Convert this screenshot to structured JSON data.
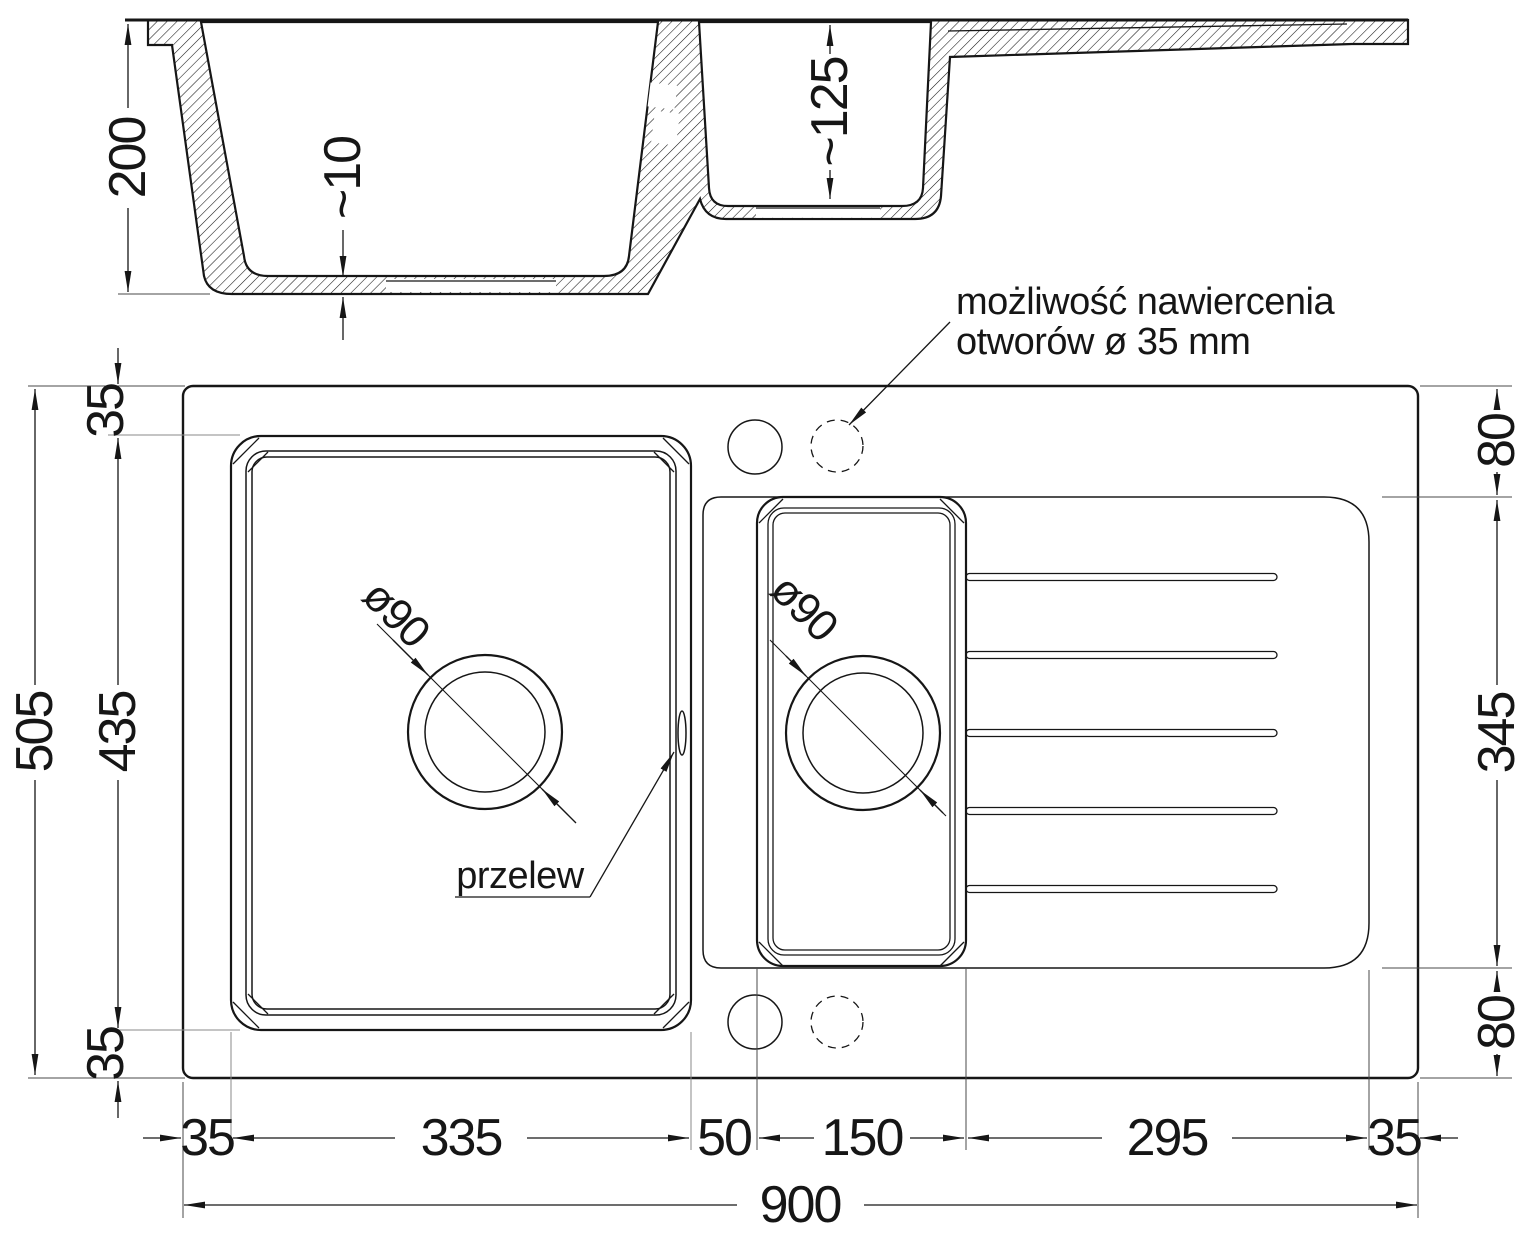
{
  "drawing": {
    "colors": {
      "line": "#161616",
      "background": "#ffffff"
    },
    "section_view": {
      "depth_main": "200",
      "floor_thickness": "~10",
      "depth_small": "~125"
    },
    "plan_view": {
      "annotations": {
        "drill_note_line1": "możliwość nawiercenia",
        "drill_note_line2": "otworów ø 35 mm",
        "overflow": "przelew",
        "main_drain_diameter": "ø90",
        "small_drain_diameter": "ø90"
      },
      "dims_left": {
        "total": "505",
        "margin_top": "35",
        "bowl": "435",
        "margin_bottom": "35"
      },
      "dims_right": {
        "top": "80",
        "drainer": "345",
        "bottom": "80"
      },
      "dims_bottom": {
        "m1": "35",
        "m2": "335",
        "m3": "50",
        "m4": "150",
        "m5": "295",
        "m6": "35",
        "total": "900"
      }
    }
  }
}
